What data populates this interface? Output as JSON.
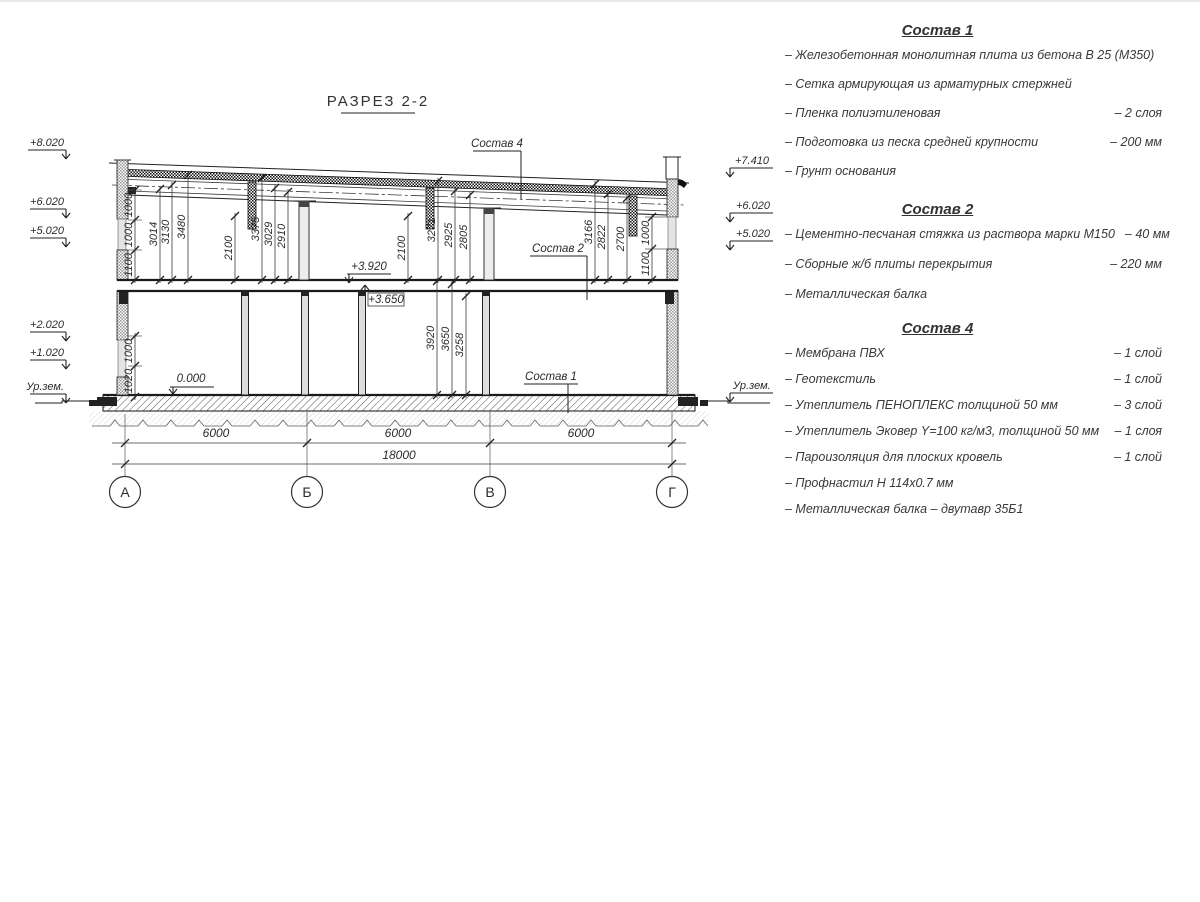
{
  "section": {
    "title": "РАЗРЕЗ 2-2",
    "axes": [
      "А",
      "Б",
      "В",
      "Г"
    ],
    "bottom_dims": [
      "6000",
      "6000",
      "6000"
    ],
    "total_dim": "18000",
    "elev_left": [
      "+8.020",
      "+6.020",
      "+5.020",
      "+2.020",
      "+1.020",
      "Ур.зем."
    ],
    "elev_right": [
      "+7.410",
      "+6.020",
      "+5.020",
      "Ур.зем."
    ],
    "inline": {
      "floor2": "+3.920",
      "ceil1": "+3.650",
      "zero": "0.000"
    },
    "callouts": {
      "c4": "Состав 4",
      "c2": "Состав 2",
      "c1": "Состав 1"
    },
    "dims": {
      "up_left_chain": [
        "1000",
        "1000",
        "1100"
      ],
      "up_bay1": [
        "3014",
        "3130",
        "3480"
      ],
      "up_col1": "2100",
      "up_bay2": [
        "3375",
        "3029",
        "2910"
      ],
      "up_col2": "2100",
      "up_bay3": [
        "3271",
        "2925",
        "2805"
      ],
      "up_bay4": [
        "3166",
        "2822",
        "2700"
      ],
      "up_right_chain": [
        "1000",
        "1100"
      ],
      "low_left_chain": [
        "1000",
        "1020"
      ],
      "low_mid": [
        "3920",
        "3650",
        "3258"
      ]
    }
  },
  "legend": {
    "s1": {
      "title": "Состав 1",
      "items": [
        {
          "t": "– Железобетонная  монолитная плита из бетона В 25 (М350)",
          "v": ""
        },
        {
          "t": "– Сетка армирующая из арматурных стержней",
          "v": ""
        },
        {
          "t": "– Пленка полиэтиленовая",
          "v": "– 2 слоя"
        },
        {
          "t": "– Подготовка из песка средней крупности",
          "v": "– 200 мм"
        },
        {
          "t": "– Грунт основания",
          "v": ""
        }
      ]
    },
    "s2": {
      "title": "Состав 2",
      "items": [
        {
          "t": "– Цементно-песчаная стяжка из раствора марки М150",
          "v": "– 40 мм"
        },
        {
          "t": "– Сборные ж/б плиты перекрытия",
          "v": "– 220 мм"
        },
        {
          "t": "– Металлическая балка",
          "v": ""
        }
      ]
    },
    "s4": {
      "title": "Состав 4",
      "items": [
        {
          "t": "– Мембрана ПВХ",
          "v": "– 1 слой"
        },
        {
          "t": "– Геотекстиль",
          "v": "– 1 слой"
        },
        {
          "t": "– Утеплитель ПЕНОПЛЕКС толщиной 50 мм",
          "v": "– 3 слой"
        },
        {
          "t": "– Утеплитель Эковер Y=100 кг/м3, толщиной 50 мм",
          "v": "– 1 слоя"
        },
        {
          "t": "– Пароизоляция для плоских кровель",
          "v": "– 1 слой"
        },
        {
          "t": "– Профнастил Н 114х0.7 мм",
          "v": ""
        },
        {
          "t": "– Металлическая балка – двутавр 35Б1",
          "v": ""
        }
      ]
    }
  }
}
